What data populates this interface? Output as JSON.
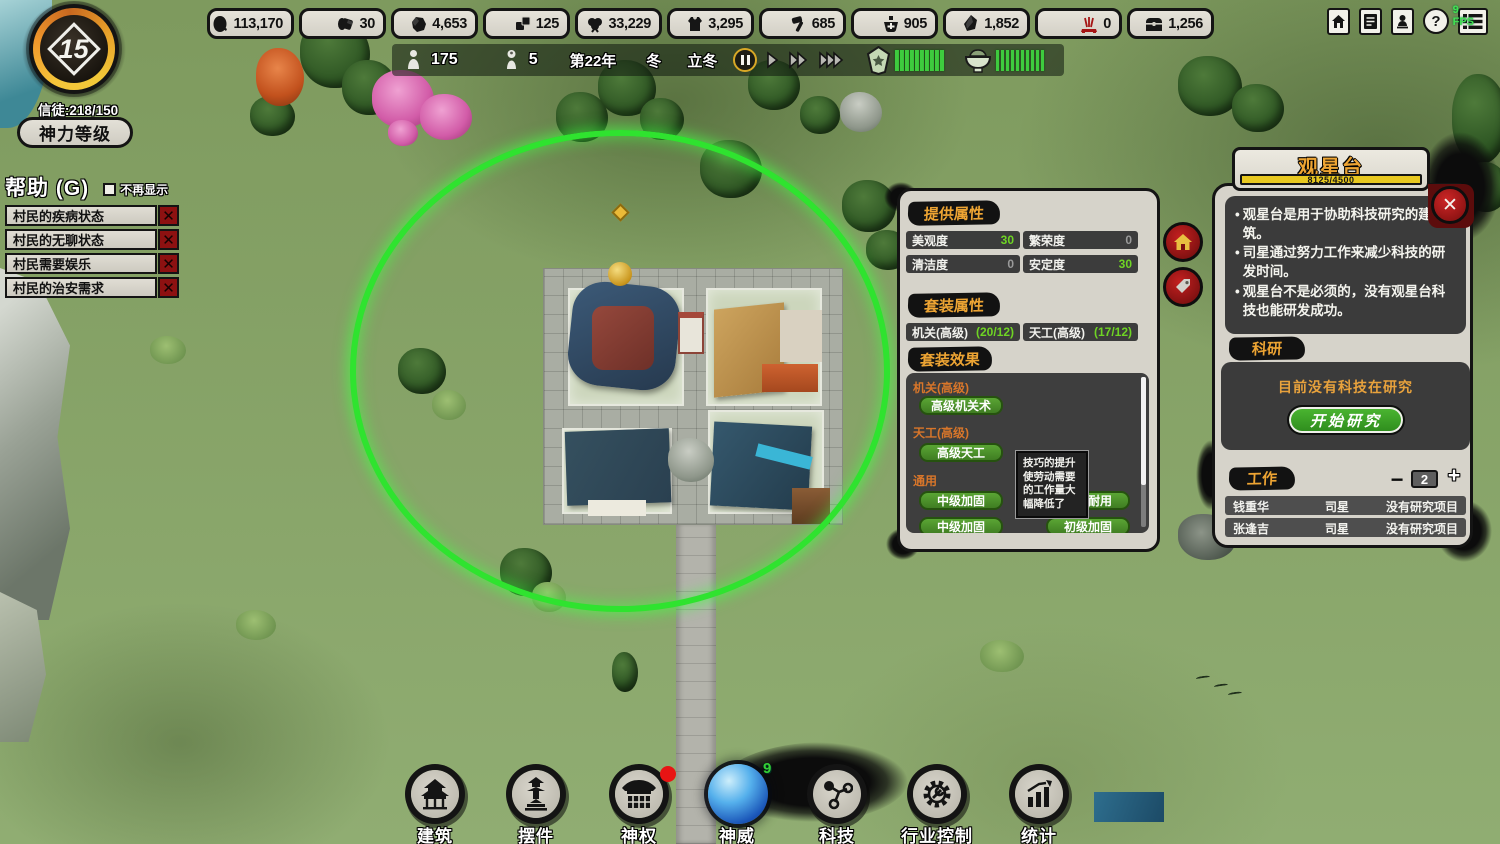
{
  "resources": [
    {
      "name": "food",
      "value": "113,170"
    },
    {
      "name": "wood",
      "value": "30"
    },
    {
      "name": "stone",
      "value": "4,653"
    },
    {
      "name": "brick",
      "value": "125"
    },
    {
      "name": "cotton",
      "value": "33,229"
    },
    {
      "name": "cloth",
      "value": "3,295"
    },
    {
      "name": "tools",
      "value": "685"
    },
    {
      "name": "medicine",
      "value": "905"
    },
    {
      "name": "ore",
      "value": "1,852"
    },
    {
      "name": "incense",
      "value": "0"
    },
    {
      "name": "treasure",
      "value": "1,256"
    }
  ],
  "sys": {
    "fps": "9 FPS",
    "help_glyph": "?"
  },
  "statusbar": {
    "population": "175",
    "idle": "5",
    "year": "第22年",
    "season": "冬",
    "solar_term": "立冬",
    "shield_bars": 10,
    "bowl_bars": 10
  },
  "level_badge": {
    "level": "15",
    "believers": "信徒:218/150",
    "button": "神力等级"
  },
  "help": {
    "title": "帮助 (G)",
    "dont_show": "不再显示",
    "dismiss_glyph": "✕",
    "items": [
      "村民的疾病状态",
      "村民的无聊状态",
      "村民需要娱乐",
      "村民的治安需求"
    ]
  },
  "mid": {
    "provided_header": "提供属性",
    "attrs": [
      {
        "label": "美观度",
        "value": "30",
        "positive": true
      },
      {
        "label": "繁荣度",
        "value": "0",
        "positive": false
      },
      {
        "label": "清洁度",
        "value": "0",
        "positive": false
      },
      {
        "label": "安定度",
        "value": "30",
        "positive": true
      }
    ],
    "set_header": "套装属性",
    "sets": [
      {
        "label": "机关(高级)",
        "value": "(20/12)"
      },
      {
        "label": "天工(高级)",
        "value": "(17/12)"
      }
    ],
    "effects_header": "套装效果",
    "groups": [
      {
        "title": "机关(高级)",
        "buttons": [
          "高级机关术"
        ]
      },
      {
        "title": "天工(高级)",
        "buttons": [
          "高级天工"
        ]
      },
      {
        "title": "通用",
        "buttons": [
          "中级加固",
          "坚固耐用",
          "中级加固",
          "初级加固"
        ]
      }
    ]
  },
  "tooltip": {
    "text": "技巧的提升使劳动需要的工作量大幅降低了"
  },
  "panel": {
    "title": "观星台",
    "progress": "8125/4500",
    "close_glyph": "✕",
    "bullets": [
      "观星台是用于协助科技研究的建筑。",
      "司星通过努力工作来减少科技的研发时间。",
      "观星台不是必须的，没有观星台科技也能研发成功。"
    ],
    "research_header": "科研",
    "research_status": "目前没有科技在研究",
    "research_button": "开始研究",
    "work_header": "工作",
    "minus_glyph": "−",
    "plus_glyph": "+",
    "worker_count": "2",
    "workers": [
      {
        "name": "钱重华",
        "job": "司星",
        "project": "没有研究项目"
      },
      {
        "name": "张逢吉",
        "job": "司星",
        "project": "没有研究项目"
      }
    ]
  },
  "toolbar": {
    "orb_count": "9",
    "items": [
      {
        "label": "建筑"
      },
      {
        "label": "摆件"
      },
      {
        "label": "神权"
      },
      {
        "label": "神威"
      },
      {
        "label": "科技"
      },
      {
        "label": "行业控制"
      },
      {
        "label": "统计"
      }
    ]
  }
}
